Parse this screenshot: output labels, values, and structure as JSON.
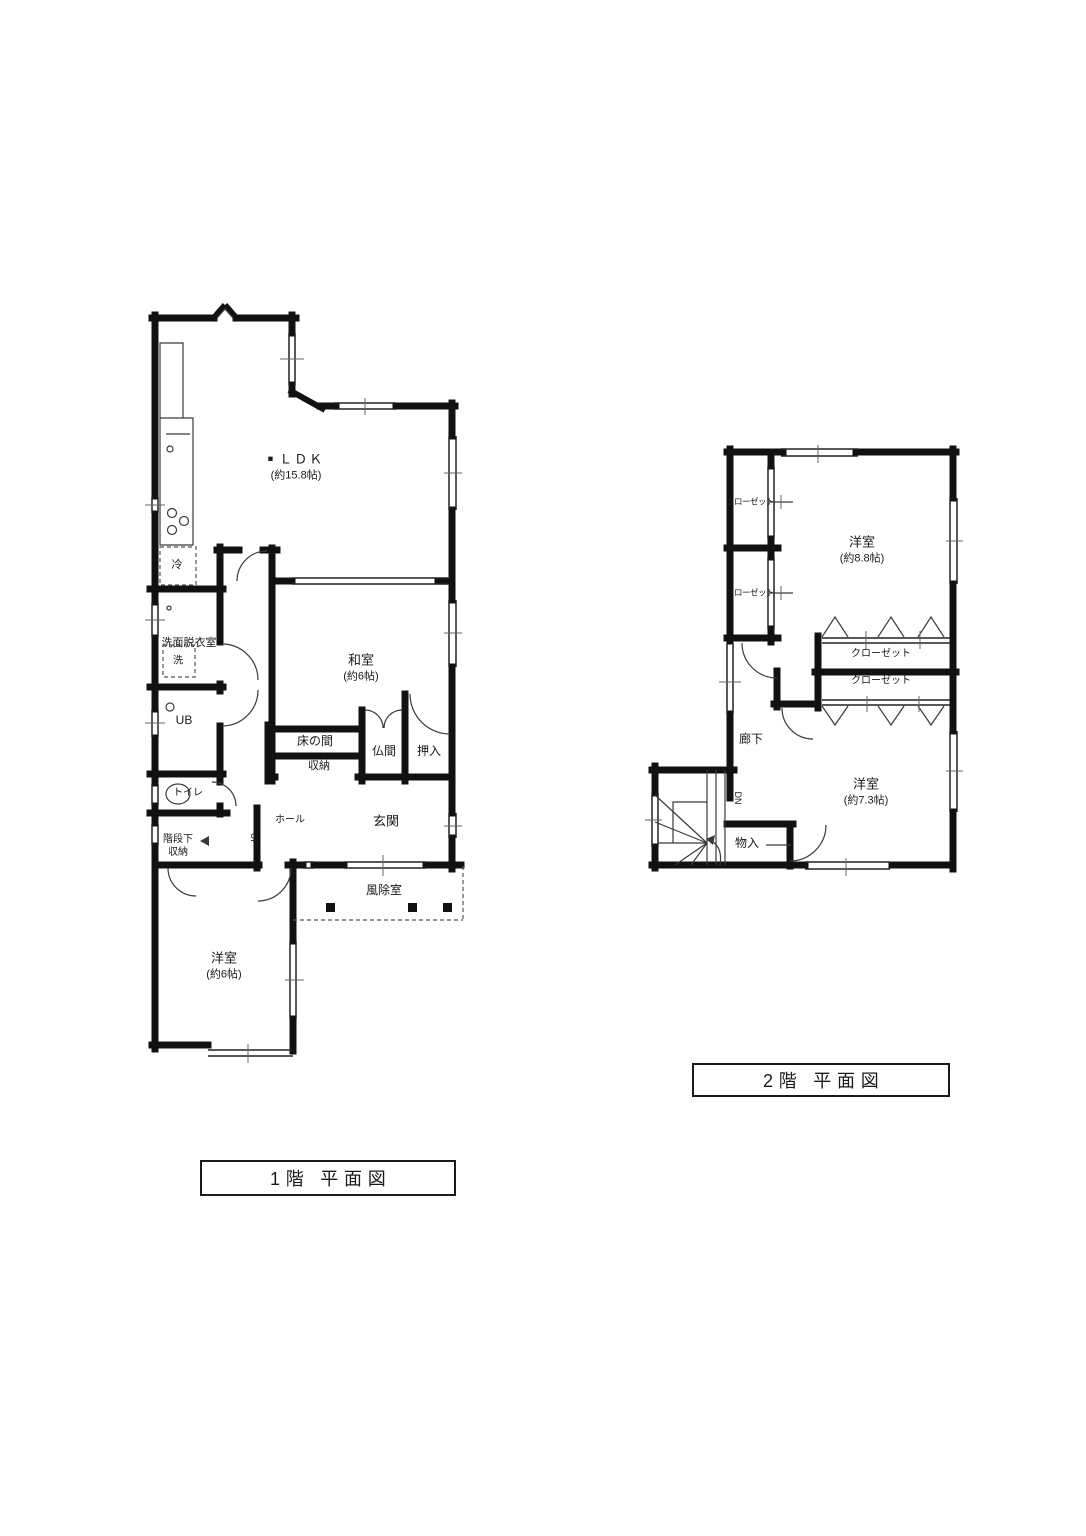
{
  "colors": {
    "wall": "#111111",
    "thin": "#3a3a3a",
    "dash": "#555555",
    "background": "#ffffff"
  },
  "floor1": {
    "title": "1階 平面図",
    "rooms": {
      "ldk_bullet": "■",
      "ldk": "ＬＤＫ",
      "ldk_size": "(約15.8帖)",
      "fridge": "冷",
      "senmen": "洗面脱衣室",
      "washer": "洗",
      "ub": "UB",
      "washitsu": "和室",
      "washitsu_size": "(約6帖)",
      "tokonoma": "床の間",
      "shunou": "収納",
      "butsuma": "仏間",
      "oshiire": "押入",
      "toilet": "トイレ",
      "kaidanshita_line1": "階段下",
      "kaidanshita_line2": "収納",
      "hall": "ホール",
      "up": "UP",
      "genkan": "玄関",
      "fujoshitsu": "風除室",
      "yoshitsu": "洋室",
      "yoshitsu_size": "(約6帖)"
    }
  },
  "floor2": {
    "title": "2階 平面図",
    "rooms": {
      "closet_left_top": "クローゼット",
      "closet_left_bottom": "クローゼット",
      "yoshitsu88": "洋室",
      "yoshitsu88_size": "(約8.8帖)",
      "closet_mid_top": "クローゼット",
      "closet_mid_bottom": "クローゼット",
      "roka": "廊下",
      "dn": "DN",
      "mononyu": "物入",
      "yoshitsu73": "洋室",
      "yoshitsu73_size": "(約7.3帖)"
    }
  }
}
